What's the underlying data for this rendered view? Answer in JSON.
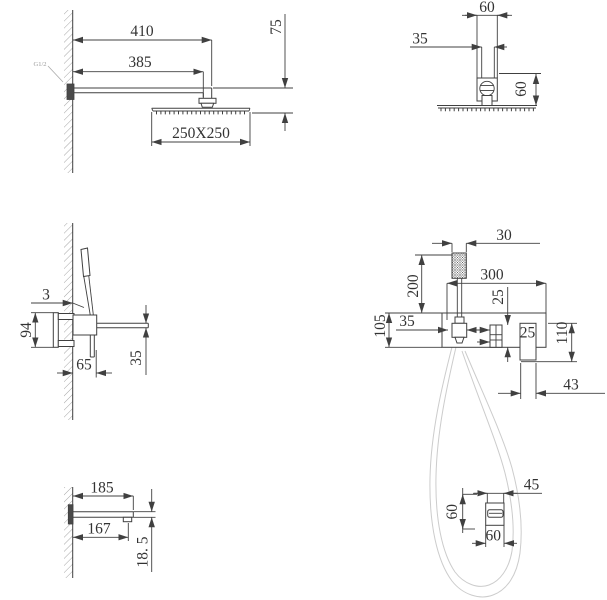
{
  "drawing": {
    "kind": "shower-set-installation-dimensions"
  },
  "views": {
    "rain_shower_side": {
      "dims": {
        "arm_length": "410",
        "arm_to_head_center": "385",
        "head_drop": "75",
        "head_size": "250X250",
        "thread_label": "G1/2"
      }
    },
    "rain_shower_front": {
      "dims": {
        "flange_width": "60",
        "pipe_width": "35",
        "flange_to_head": "60"
      }
    },
    "mixer_side": {
      "dims": {
        "wall_gap": "3",
        "bracket_height": "94",
        "body_depth": "65",
        "spout_drop": "35"
      }
    },
    "mixer_front": {
      "dims": {
        "handset_width": "30",
        "handset_height": "200",
        "body_width": "300",
        "knob_offset": "25",
        "handset_offset": "35",
        "body_height": "105",
        "outlet_width": "25",
        "outlet_drop": "110",
        "outlet_offset": "43"
      }
    },
    "spout_side": {
      "dims": {
        "spout_length": "185",
        "nozzle_offset": "167",
        "spout_thickness": "18. 5"
      }
    },
    "holder_top": {
      "dims": {
        "clip_width": "45",
        "holder_height": "60",
        "holder_width": "60"
      }
    }
  },
  "colors": {
    "line": "#404040",
    "dim_text": "#333333",
    "hose": "#cccccc",
    "thread_label": "#999999"
  }
}
